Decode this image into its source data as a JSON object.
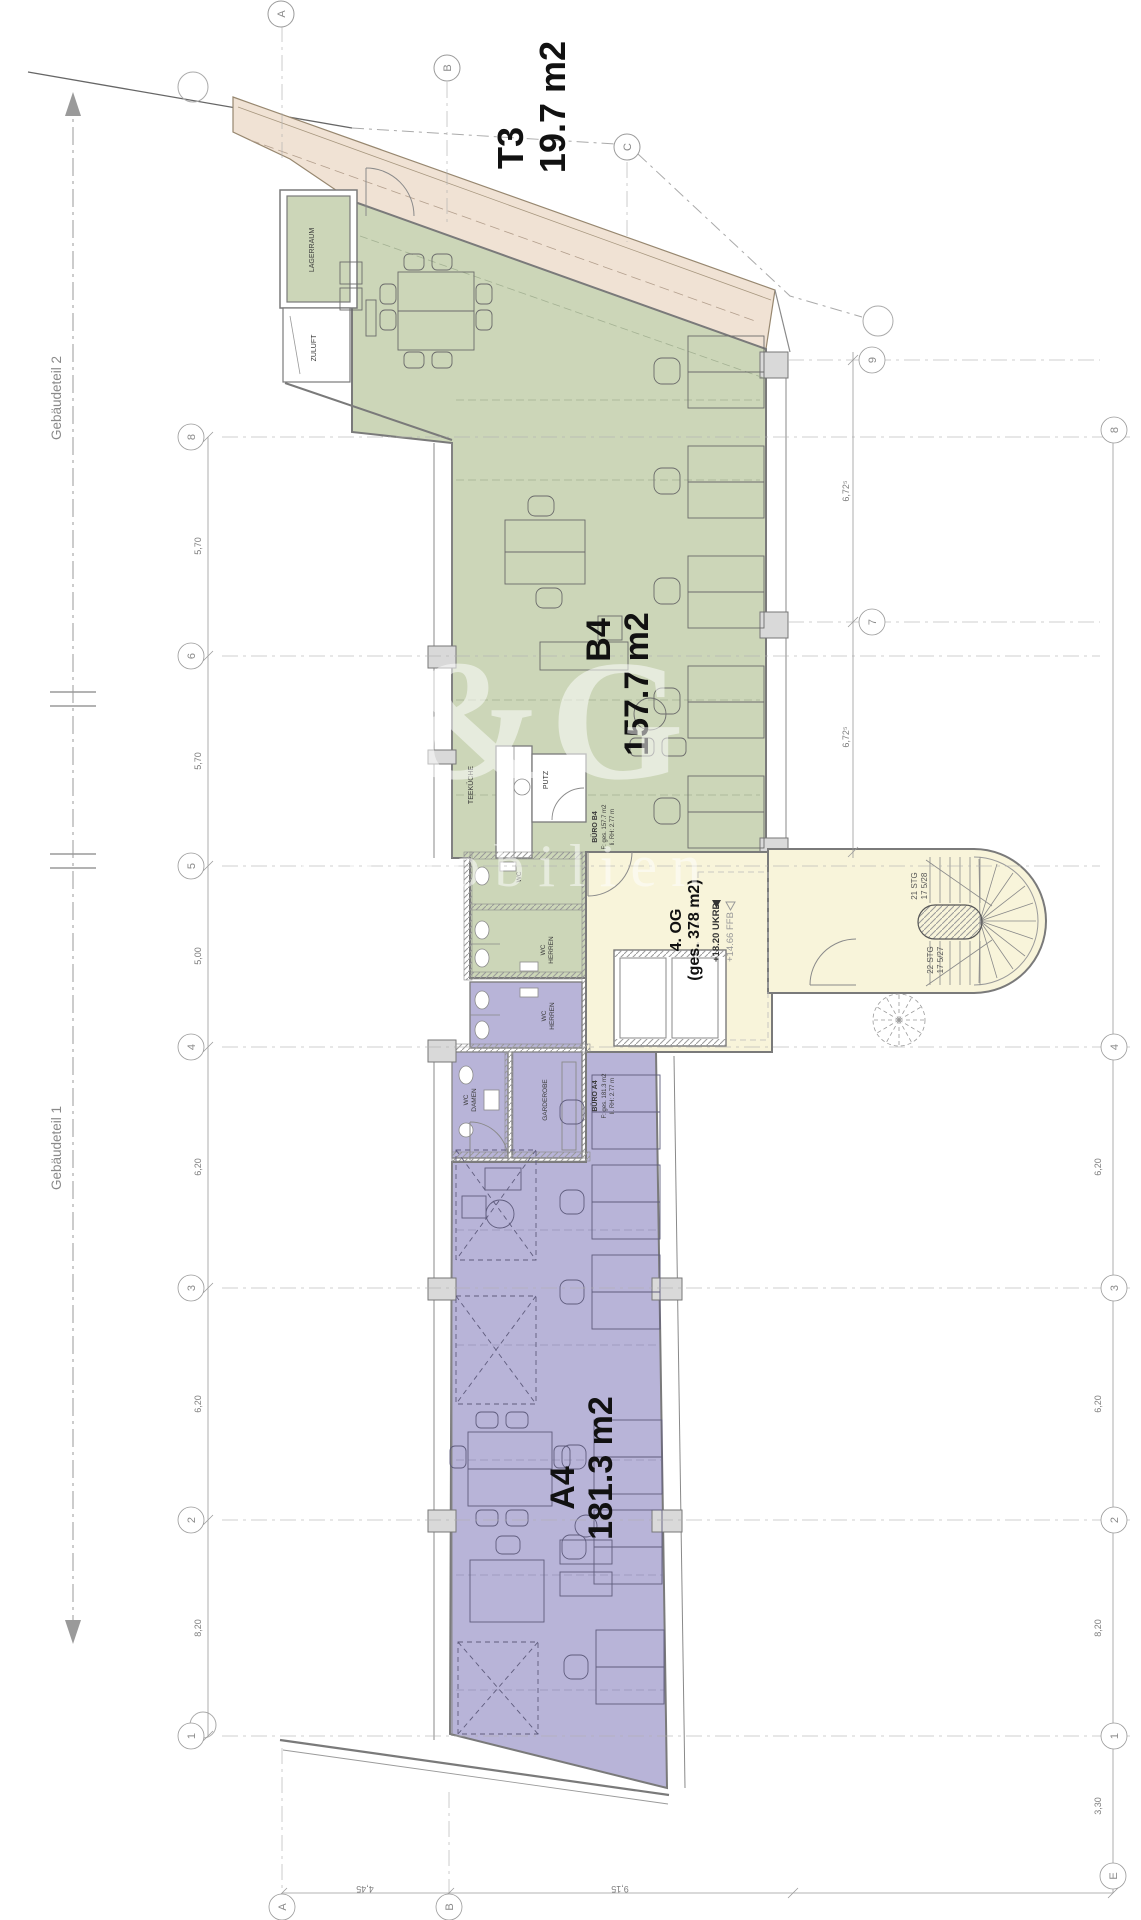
{
  "labels": {
    "t3": {
      "l1": "T3",
      "l2": "19.7 m2"
    },
    "b4": {
      "l1": "B4",
      "l2": "157.7 m2"
    },
    "a4": {
      "l1": "A4",
      "l2": "181.3 m2"
    },
    "og": {
      "l1": "4. OG",
      "l2": "(ges. 378 m2)"
    },
    "levels": {
      "l1": "+18.20 UKRD",
      "l2": "+14.66 FFB"
    }
  },
  "rooms": {
    "lagerraum": "LAGERRAUM",
    "zuluft": "ZULUFT",
    "teekueche": "TEEKÜCHE",
    "putz": "PUTZ",
    "wc": "WC",
    "wc_b4_1": "WC",
    "wc_b4_2": "HERREN",
    "wc_a4_1": "WC",
    "wc_a4_2": "HERREN",
    "wc_d_1": "WC",
    "wc_d_2": "DAMEN",
    "garderobe": "GARDEROBE"
  },
  "tags": {
    "b4": [
      "BÜRO B4",
      "F: ges. 157.7 m2",
      "li. RH: 2.77 m"
    ],
    "a4": [
      "BÜRO A4",
      "F: ges. 181.3 m2",
      "li. RH: 2.77 m"
    ]
  },
  "stairs": {
    "s1a": "21 STG",
    "s1b": "17 5/28",
    "s2a": "22 STG",
    "s2b": "17 5/27"
  },
  "sections": {
    "p1": "Gebäudeteil 1",
    "p2": "Gebäudeteil 2"
  },
  "grid": {
    "top": [
      "A",
      "B",
      "C"
    ],
    "left": [
      "8",
      "6",
      "5",
      "4",
      "3",
      "2",
      "1"
    ],
    "right_inner": [
      "9",
      "7"
    ],
    "right_outer": [
      "8",
      "4",
      "3",
      "2",
      "1"
    ],
    "bottom": [
      "A",
      "B",
      "E"
    ]
  },
  "dims": {
    "left": [
      "5,70",
      "5,70",
      "5,00",
      "6,20",
      "6,20",
      "8,20"
    ],
    "inner": [
      "6,72⁵",
      "6,72⁵"
    ],
    "outer": [
      "6,20",
      "6,20",
      "8,20",
      "3,30"
    ],
    "bottom": [
      "4,45",
      "9,15"
    ]
  },
  "watermark": {
    "l1": "E&G",
    "l2": "Immobilien"
  },
  "colors": {
    "green": "#ccd6b8",
    "terrace": "#f0e2d4",
    "yellow": "#f8f4da",
    "purple": "#b8b4d8"
  }
}
